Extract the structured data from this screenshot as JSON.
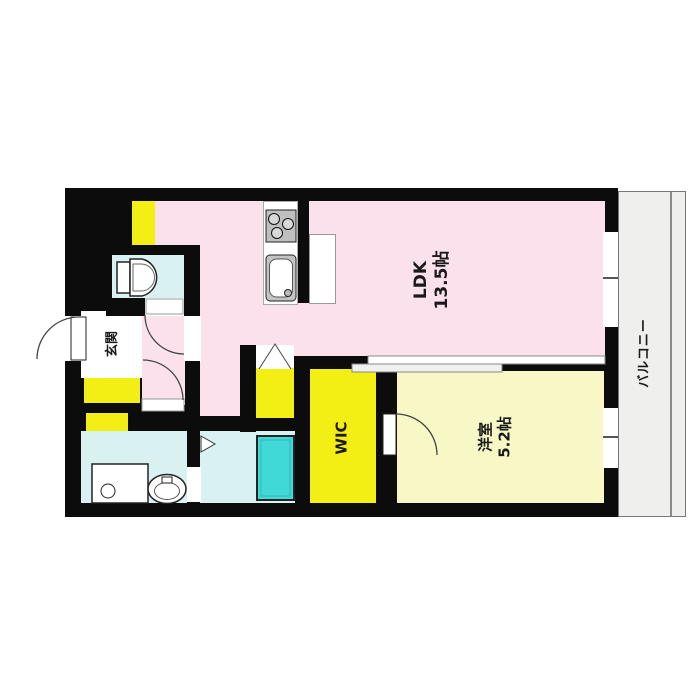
{
  "plan": {
    "type": "apartment-floor-plan",
    "rooms": {
      "ldk": {
        "label": "LDK",
        "area": "13.5帖",
        "color": "#fae1eb"
      },
      "western_room": {
        "label": "洋室",
        "area": "5.2帖",
        "color": "#f8f7c6"
      },
      "wic": {
        "label": "WIC",
        "color": "#f3ee14"
      },
      "entrance": {
        "label": "玄関",
        "color": "#ffffff"
      },
      "balcony": {
        "label": "バルコニー",
        "color": "#efefed"
      },
      "toilet": {
        "color": "#d9f1f0"
      },
      "washroom": {
        "color": "#d9f1f0"
      },
      "bathroom": {
        "color": "#d9f1f0"
      },
      "closet": {
        "color": "#f3ee14"
      }
    },
    "colors": {
      "wall": "#0c0c0c",
      "accent_yellow": "#f3ee14",
      "pale_yellow": "#f8f7c6",
      "pink": "#fae1eb",
      "light_cyan": "#d9f1f0",
      "bathtub": "#41d8d8",
      "balcony_gray": "#efefed",
      "background": "#ffffff"
    },
    "fixtures": {
      "toilet-icon": "tank + D-bowl outline",
      "stove-icon": "gray square, 3 burner circles",
      "sink-icon": "rounded rect basin",
      "refrigerator-space": "white outlined rectangle",
      "washing-machine-icon": "square with drain circle",
      "washbasin-icon": "double ellipse",
      "bathtub-icon": "cyan rectangle",
      "door-swing-arc": "quarter circle",
      "folding-door-symbol": "zigzag triangle",
      "sliding-door-symbol": "overlapping thin panels"
    }
  }
}
